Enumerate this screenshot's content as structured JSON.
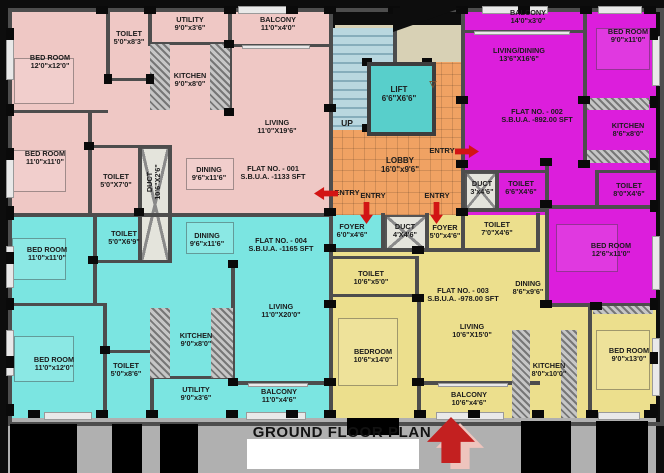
{
  "caption": {
    "text": "GROUND FLOOR PLAN"
  },
  "palette": {
    "flat1_pink": "#efc8c5",
    "flat2_magenta": "#dc1edc",
    "flat3_yellow": "#ecdf8d",
    "flat4_cyan": "#7be5e1",
    "lobby_orange": "#f0a263",
    "lift_teal": "#58cfcb",
    "stairs_blue": "#b9d7df",
    "landing_beige": "#d8d1b5",
    "wall_gray": "#4d4d4d",
    "frame_black": "#0d0d0d",
    "entry_red": "#d21414",
    "walkway_gray": "#b0b0b0"
  },
  "flats": [
    {
      "no": "FLAT NO. - 001",
      "sbua": "S.B.U.A. -1133 SFT",
      "color": "#efc8c5"
    },
    {
      "no": "FLAT NO. - 002",
      "sbua": "S.B.U.A. -892.00 SFT",
      "color": "#dc1edc"
    },
    {
      "no": "FLAT NO. - 003",
      "sbua": "S.B.U.A. -978.00 SFT",
      "color": "#ecdf8d"
    },
    {
      "no": "FLAT NO. - 004",
      "sbua": "S.B.U.A. -1165 SFT",
      "color": "#7be5e1"
    }
  ],
  "zones": [
    {
      "n": "flat-001-area",
      "x": 8,
      "y": 8,
      "w": 323,
      "h": 207,
      "c": "#efc8c5"
    },
    {
      "n": "flat-004-area",
      "x": 8,
      "y": 215,
      "w": 323,
      "h": 203,
      "c": "#7be5e1"
    },
    {
      "n": "flat-002-area",
      "x": 463,
      "y": 8,
      "w": 193,
      "h": 207,
      "c": "#dc1edc"
    },
    {
      "n": "flat-002-ext",
      "x": 545,
      "y": 215,
      "w": 111,
      "h": 92,
      "c": "#dc1edc"
    },
    {
      "n": "flat-003-area",
      "x": 331,
      "y": 215,
      "w": 214,
      "h": 203,
      "c": "#ecdf8d"
    },
    {
      "n": "flat-003-ext",
      "x": 545,
      "y": 307,
      "w": 111,
      "h": 111,
      "c": "#ecdf8d"
    },
    {
      "n": "stair-landing",
      "x": 335,
      "y": 25,
      "w": 128,
      "h": 40,
      "c": "#d8d1b5"
    },
    {
      "n": "staircase",
      "x": 331,
      "y": 28,
      "w": 62,
      "h": 102,
      "c": "#b9d7df",
      "p": "steps"
    },
    {
      "n": "lobby-mid",
      "x": 331,
      "y": 130,
      "w": 132,
      "h": 85,
      "c": "#f0a263",
      "p": "tiles"
    },
    {
      "n": "lobby-right",
      "x": 430,
      "y": 62,
      "w": 33,
      "h": 68,
      "c": "#f0a263",
      "p": "tiles"
    },
    {
      "n": "foyer-004",
      "x": 331,
      "y": 215,
      "w": 52,
      "h": 37,
      "c": "#7be5e1"
    },
    {
      "n": "duct-lobby",
      "x": 385,
      "y": 215,
      "w": 42,
      "h": 37,
      "c": "#e4e4dc",
      "p": "ductx"
    },
    {
      "n": "duct-002",
      "x": 465,
      "y": 172,
      "w": 32,
      "h": 38,
      "c": "#e4e4dc",
      "p": "ductx"
    },
    {
      "n": "duct-shaft-001-004",
      "x": 140,
      "y": 147,
      "w": 30,
      "h": 115,
      "c": "#e4e4dc",
      "p": "ductx"
    }
  ],
  "walls": [
    [
      329,
      8,
      4,
      410
    ],
    [
      8,
      213,
      323,
      4
    ],
    [
      461,
      8,
      4,
      209
    ],
    [
      106,
      8,
      4,
      74
    ],
    [
      148,
      8,
      4,
      38
    ],
    [
      106,
      78,
      46,
      3
    ],
    [
      150,
      42,
      80,
      3
    ],
    [
      228,
      8,
      4,
      104
    ],
    [
      228,
      44,
      103,
      3
    ],
    [
      8,
      110,
      100,
      3
    ],
    [
      88,
      113,
      4,
      102
    ],
    [
      88,
      145,
      84,
      3
    ],
    [
      138,
      145,
      4,
      117
    ],
    [
      168,
      145,
      4,
      117
    ],
    [
      93,
      215,
      4,
      90
    ],
    [
      93,
      260,
      79,
      3
    ],
    [
      8,
      303,
      97,
      3
    ],
    [
      103,
      303,
      4,
      115
    ],
    [
      103,
      350,
      49,
      3
    ],
    [
      150,
      350,
      4,
      68
    ],
    [
      150,
      376,
      83,
      3
    ],
    [
      231,
      262,
      4,
      121
    ],
    [
      231,
      381,
      100,
      4
    ],
    [
      583,
      8,
      4,
      96
    ],
    [
      465,
      30,
      120,
      3
    ],
    [
      583,
      100,
      73,
      4
    ],
    [
      583,
      104,
      4,
      60
    ],
    [
      545,
      160,
      4,
      147
    ],
    [
      545,
      205,
      111,
      4
    ],
    [
      545,
      303,
      111,
      4
    ],
    [
      465,
      170,
      84,
      3
    ],
    [
      495,
      170,
      4,
      40
    ],
    [
      465,
      208,
      84,
      4
    ],
    [
      595,
      170,
      4,
      38
    ],
    [
      595,
      170,
      61,
      3
    ],
    [
      329,
      248,
      211,
      4
    ],
    [
      381,
      213,
      4,
      39
    ],
    [
      425,
      213,
      4,
      39
    ],
    [
      461,
      213,
      4,
      39
    ],
    [
      536,
      213,
      4,
      39
    ],
    [
      331,
      256,
      88,
      3
    ],
    [
      415,
      256,
      4,
      42
    ],
    [
      331,
      294,
      88,
      3
    ],
    [
      417,
      298,
      4,
      120
    ],
    [
      417,
      381,
      123,
      4
    ],
    [
      588,
      305,
      4,
      113
    ],
    [
      393,
      25,
      4,
      40
    ]
  ],
  "hatches": [
    [
      150,
      44,
      20,
      66
    ],
    [
      210,
      44,
      20,
      66
    ],
    [
      150,
      308,
      20,
      70
    ],
    [
      211,
      308,
      22,
      70
    ],
    [
      587,
      98,
      62,
      12
    ],
    [
      587,
      150,
      62,
      13
    ],
    [
      512,
      330,
      18,
      88
    ],
    [
      561,
      330,
      16,
      88
    ],
    [
      593,
      306,
      60,
      8
    ]
  ],
  "windows": [
    [
      6,
      36,
      6,
      42
    ],
    [
      6,
      158,
      6,
      38
    ],
    [
      6,
      246,
      6,
      40
    ],
    [
      6,
      330,
      6,
      44
    ],
    [
      238,
      6,
      58,
      6
    ],
    [
      482,
      6,
      64,
      6
    ],
    [
      598,
      6,
      42,
      6
    ],
    [
      652,
      36,
      6,
      48
    ],
    [
      652,
      236,
      6,
      52
    ],
    [
      652,
      338,
      6,
      56
    ],
    [
      44,
      412,
      46,
      6
    ],
    [
      246,
      412,
      58,
      6
    ],
    [
      436,
      412,
      66,
      6
    ],
    [
      598,
      412,
      40,
      6
    ],
    [
      242,
      45,
      66,
      2
    ],
    [
      474,
      31,
      94,
      2
    ],
    [
      248,
      383,
      58,
      2
    ],
    [
      438,
      383,
      68,
      2
    ]
  ],
  "columns": [
    [
      96,
      6,
      12,
      8
    ],
    [
      144,
      6,
      12,
      8
    ],
    [
      224,
      6,
      12,
      8
    ],
    [
      286,
      6,
      12,
      8
    ],
    [
      324,
      6,
      12,
      8
    ],
    [
      388,
      6,
      12,
      8
    ],
    [
      456,
      6,
      12,
      8
    ],
    [
      518,
      6,
      12,
      8
    ],
    [
      580,
      6,
      12,
      8
    ],
    [
      644,
      6,
      12,
      8
    ],
    [
      6,
      28,
      8,
      12
    ],
    [
      6,
      104,
      8,
      12
    ],
    [
      6,
      148,
      8,
      12
    ],
    [
      6,
      206,
      8,
      14
    ],
    [
      6,
      252,
      8,
      12
    ],
    [
      6,
      298,
      8,
      12
    ],
    [
      6,
      356,
      8,
      12
    ],
    [
      6,
      404,
      8,
      12
    ],
    [
      650,
      28,
      8,
      12
    ],
    [
      650,
      96,
      8,
      12
    ],
    [
      650,
      158,
      8,
      12
    ],
    [
      650,
      200,
      8,
      12
    ],
    [
      650,
      298,
      8,
      12
    ],
    [
      650,
      352,
      8,
      12
    ],
    [
      650,
      404,
      8,
      12
    ],
    [
      28,
      410,
      12,
      8
    ],
    [
      96,
      410,
      12,
      8
    ],
    [
      146,
      410,
      12,
      8
    ],
    [
      226,
      410,
      12,
      8
    ],
    [
      286,
      410,
      12,
      8
    ],
    [
      324,
      410,
      12,
      8
    ],
    [
      414,
      410,
      12,
      8
    ],
    [
      468,
      410,
      12,
      8
    ],
    [
      532,
      410,
      12,
      8
    ],
    [
      586,
      410,
      12,
      8
    ],
    [
      644,
      410,
      12,
      8
    ],
    [
      324,
      104,
      12,
      8
    ],
    [
      324,
      208,
      12,
      8
    ],
    [
      324,
      244,
      12,
      8
    ],
    [
      324,
      300,
      12,
      8
    ],
    [
      324,
      378,
      12,
      8
    ],
    [
      456,
      96,
      12,
      8
    ],
    [
      456,
      160,
      12,
      8
    ],
    [
      456,
      208,
      12,
      8
    ],
    [
      540,
      158,
      12,
      8
    ],
    [
      540,
      200,
      12,
      8
    ],
    [
      540,
      300,
      12,
      8
    ],
    [
      578,
      96,
      12,
      8
    ],
    [
      578,
      160,
      12,
      8
    ],
    [
      412,
      246,
      12,
      8
    ],
    [
      412,
      294,
      12,
      8
    ],
    [
      412,
      378,
      12,
      8
    ],
    [
      84,
      142,
      10,
      8
    ],
    [
      134,
      208,
      10,
      8
    ],
    [
      88,
      256,
      10,
      8
    ],
    [
      100,
      346,
      10,
      8
    ],
    [
      224,
      40,
      10,
      8
    ],
    [
      224,
      108,
      10,
      8
    ],
    [
      228,
      260,
      10,
      8
    ],
    [
      228,
      378,
      10,
      8
    ],
    [
      590,
      302,
      12,
      8
    ],
    [
      104,
      74,
      8,
      10
    ],
    [
      146,
      74,
      8,
      10
    ],
    [
      362,
      58,
      10,
      8
    ],
    [
      422,
      58,
      10,
      8
    ],
    [
      362,
      124,
      10,
      8
    ],
    [
      422,
      124,
      10,
      8
    ]
  ],
  "furniture": [
    [
      14,
      58,
      58,
      44
    ],
    [
      12,
      150,
      52,
      40
    ],
    [
      12,
      238,
      52,
      40
    ],
    [
      14,
      336,
      58,
      44
    ],
    [
      596,
      28,
      52,
      40
    ],
    [
      556,
      224,
      60,
      46
    ],
    [
      596,
      330,
      52,
      58
    ],
    [
      338,
      318,
      58,
      66
    ],
    [
      186,
      158,
      46,
      30
    ],
    [
      186,
      222,
      46,
      30
    ]
  ],
  "lift": {
    "x": 367,
    "y": 62,
    "w": 61,
    "h": 66,
    "c": "#58cfcb"
  },
  "wedge": {
    "x": 393,
    "y": 8,
    "w": 68,
    "h": 24
  },
  "labels": [
    {
      "t": [
        "BED ROOM",
        "12'0\"x12'0\""
      ],
      "x": 50,
      "y": 62
    },
    {
      "t": [
        "TOILET",
        "5'0\"x8'3\""
      ],
      "x": 129,
      "y": 38
    },
    {
      "t": [
        "UTILITY",
        "9'0\"x3'6\""
      ],
      "x": 190,
      "y": 24
    },
    {
      "t": [
        "BALCONY",
        "11'0\"x4'0\""
      ],
      "x": 278,
      "y": 24
    },
    {
      "t": [
        "KITCHEN",
        "9'0\"x8'0\""
      ],
      "x": 190,
      "y": 80
    },
    {
      "t": [
        "LIVING",
        "11'0\"X19'6\""
      ],
      "x": 277,
      "y": 127
    },
    {
      "t": [
        "BED ROOM",
        "11'0\"x11'0\""
      ],
      "x": 45,
      "y": 158
    },
    {
      "t": [
        "TOILET",
        "5'0\"X7'0\""
      ],
      "x": 116,
      "y": 181
    },
    {
      "t": [
        "DUCT",
        "10'6\"X2'6\""
      ],
      "x": 154,
      "y": 182,
      "rot": true
    },
    {
      "t": [
        "DINING",
        "9'6\"x11'6\""
      ],
      "x": 209,
      "y": 174
    },
    {
      "t": [
        "FLAT NO. - 001",
        "S.B.U.A. -1133 SFT"
      ],
      "x": 273,
      "y": 173
    },
    {
      "t": [
        "TOILET",
        "5'0\"X6'9\""
      ],
      "x": 124,
      "y": 238
    },
    {
      "t": [
        "DINING",
        "9'6\"x11'6\""
      ],
      "x": 207,
      "y": 240
    },
    {
      "t": [
        "FLAT NO. - 004",
        "S.B.U.A. -1165 SFT"
      ],
      "x": 281,
      "y": 245
    },
    {
      "t": [
        "BED ROOM",
        "11'0\"x11'0\""
      ],
      "x": 47,
      "y": 254
    },
    {
      "t": [
        "BED ROOM",
        "11'0\"x12'0\""
      ],
      "x": 54,
      "y": 364
    },
    {
      "t": [
        "TOILET",
        "5'0\"x8'6\""
      ],
      "x": 126,
      "y": 370
    },
    {
      "t": [
        "KITCHEN",
        "9'0\"x8'0\""
      ],
      "x": 196,
      "y": 340
    },
    {
      "t": [
        "UTILITY",
        "9'0\"x3'6\""
      ],
      "x": 196,
      "y": 394
    },
    {
      "t": [
        "LIVING",
        "11'0\"X20'0\""
      ],
      "x": 281,
      "y": 311
    },
    {
      "t": [
        "BALCONY",
        "11'0\"x4'6\""
      ],
      "x": 279,
      "y": 396
    },
    {
      "t": [
        "BALCONY",
        "14'0\"x3'0\""
      ],
      "x": 528,
      "y": 17
    },
    {
      "t": [
        "LIVING/DINING",
        "13'6\"X16'6\""
      ],
      "x": 519,
      "y": 55
    },
    {
      "t": [
        "BED ROOM",
        "9'0\"x11'0\""
      ],
      "x": 628,
      "y": 36
    },
    {
      "t": [
        "FLAT NO. - 002",
        "S.B.U.A. -892.00 SFT"
      ],
      "x": 537,
      "y": 116
    },
    {
      "t": [
        "KITCHEN",
        "8'6\"x8'0\""
      ],
      "x": 628,
      "y": 130
    },
    {
      "t": [
        "TOILET",
        "6'6\"X4'6\""
      ],
      "x": 521,
      "y": 188
    },
    {
      "t": [
        "TOILET",
        "8'0\"X4'6\""
      ],
      "x": 629,
      "y": 190
    },
    {
      "t": [
        "BED ROOM",
        "12'6\"x11'0\""
      ],
      "x": 611,
      "y": 250
    },
    {
      "t": [
        "DUCT",
        "3'x4'6\""
      ],
      "x": 482,
      "y": 188
    },
    {
      "t": [
        "LIFT",
        "6'6\"X6'6\""
      ],
      "x": 399,
      "y": 95,
      "s": 8
    },
    {
      "t": [
        "UP"
      ],
      "x": 347,
      "y": 124,
      "s": 8.5
    },
    {
      "t": [
        "▽"
      ],
      "x": 433,
      "y": 84,
      "s": 9,
      "c": "#7a5230"
    },
    {
      "t": [
        "LOBBY",
        "16'0\"x9'6\""
      ],
      "x": 400,
      "y": 166,
      "s": 8
    },
    {
      "t": [
        "FOYER",
        "6'0\"x4'6\""
      ],
      "x": 352,
      "y": 231
    },
    {
      "t": [
        "DUCT",
        "4'X4'6\""
      ],
      "x": 405,
      "y": 231
    },
    {
      "t": [
        "FOYER",
        "5'0\"x4'6\""
      ],
      "x": 445,
      "y": 232
    },
    {
      "t": [
        "TOILET",
        "7'0\"X4'6\""
      ],
      "x": 497,
      "y": 229
    },
    {
      "t": [
        "TOILET",
        "10'6\"x5'0\""
      ],
      "x": 371,
      "y": 278
    },
    {
      "t": [
        "FLAT NO. - 003",
        "S.B.U.A. -978.00 SFT"
      ],
      "x": 463,
      "y": 295
    },
    {
      "t": [
        "DINING",
        "8'6\"x9'6\""
      ],
      "x": 528,
      "y": 288
    },
    {
      "t": [
        "LIVING",
        "10'6\"X15'0\""
      ],
      "x": 472,
      "y": 331
    },
    {
      "t": [
        "BEDROOM",
        "10'6\"x14'0\""
      ],
      "x": 373,
      "y": 356
    },
    {
      "t": [
        "BALCONY",
        "10'6\"x4'6\""
      ],
      "x": 469,
      "y": 399
    },
    {
      "t": [
        "KITCHEN",
        "8'0\"x10'0\""
      ],
      "x": 549,
      "y": 370
    },
    {
      "t": [
        "BED ROOM",
        "9'0\"x13'0\""
      ],
      "x": 629,
      "y": 355
    }
  ],
  "entries": [
    {
      "t": "ENTRY",
      "x": 347,
      "y": 193,
      "dir": "left",
      "ax": 314,
      "ay": 187,
      "aw": 24,
      "ah": 13
    },
    {
      "t": "ENTRY",
      "x": 373,
      "y": 196,
      "dir": "down",
      "ax": 360,
      "ay": 202,
      "aw": 13,
      "ah": 22
    },
    {
      "t": "ENTRY",
      "x": 437,
      "y": 196,
      "dir": "down",
      "ax": 430,
      "ay": 202,
      "aw": 13,
      "ah": 22
    },
    {
      "t": "ENTRY",
      "x": 442,
      "y": 151,
      "dir": "right",
      "ax": 455,
      "ay": 145,
      "aw": 24,
      "ah": 13
    }
  ],
  "walkway_blocks": [
    [
      10,
      424,
      67,
      49
    ],
    [
      112,
      424,
      30,
      49
    ],
    [
      160,
      424,
      38,
      49
    ],
    [
      347,
      418,
      52,
      17
    ],
    [
      521,
      421,
      50,
      52
    ],
    [
      596,
      421,
      52,
      52
    ]
  ]
}
